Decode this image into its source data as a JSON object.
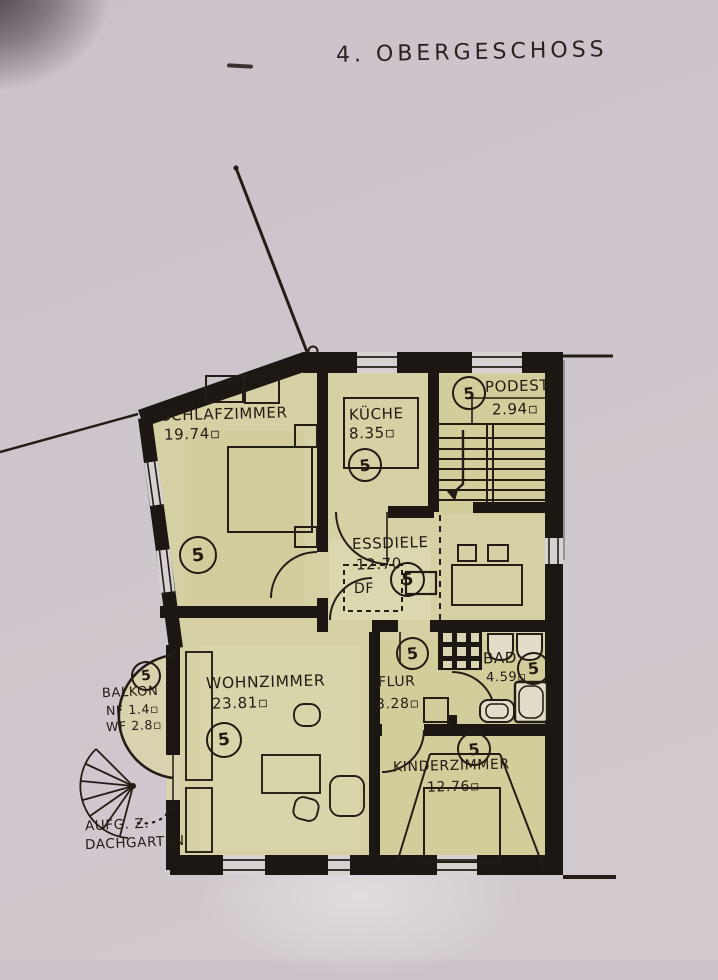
{
  "title": "4. OBERGESCHOSS",
  "colors": {
    "paper": "#ccc3ca",
    "wash": "#d6d1a4",
    "ink": "#221b13"
  },
  "rooms": {
    "schlafzimmer": {
      "name": "SCHLAFZIMMER",
      "area": "19.74▫",
      "number": "5"
    },
    "kueche": {
      "name": "KÜCHE",
      "area": "8.35▫",
      "number": "5"
    },
    "podest": {
      "name": "PODEST",
      "area": "2.94▫",
      "number": "5"
    },
    "essdiele": {
      "name": "ESSDIELE",
      "area": "12.70",
      "number": "5",
      "skylight_label": "DF"
    },
    "wohnzimmer": {
      "name": "WOHNZIMMER",
      "area": "23.81▫",
      "number": "5"
    },
    "flur": {
      "name": "FLUR",
      "area": "3.28▫",
      "number": "5"
    },
    "bad": {
      "name": "BAD",
      "area": "4.59▫",
      "number": "5"
    },
    "kinderzimmer": {
      "name": "KINDERZIMMER",
      "area": "12.76▫",
      "number": "5"
    },
    "balkon": {
      "name": "BALKON",
      "nf": "NF 1.4▫",
      "wf": "WF 2.8▫",
      "number": "5"
    }
  },
  "annotations": {
    "roof_access_line1": "AUFG. Z.",
    "roof_access_line2": "DACHGARTEN"
  }
}
